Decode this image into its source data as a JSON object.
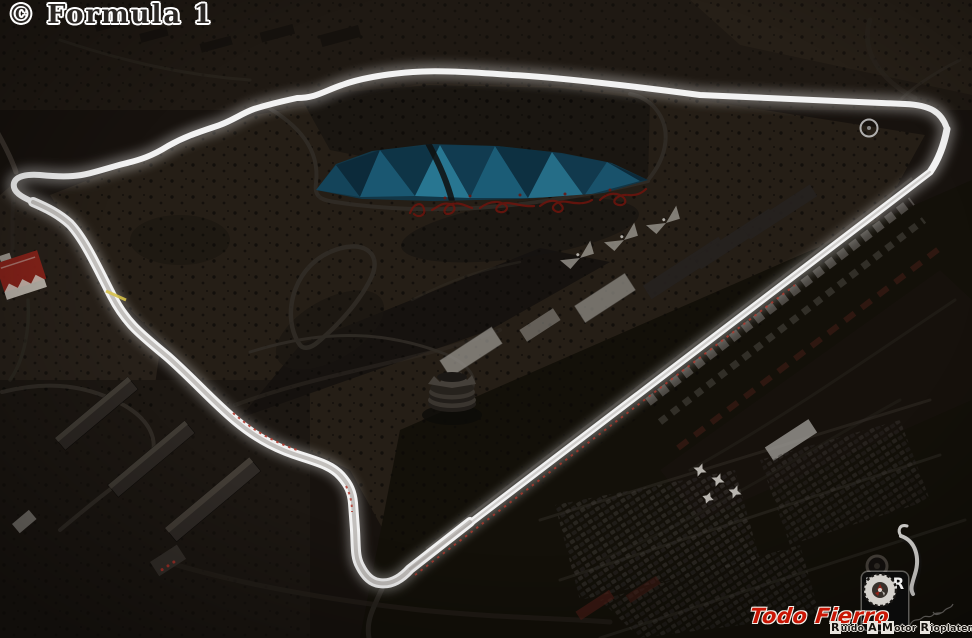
{
  "watermarks": {
    "formula1": "© Formula 1",
    "todo_fierro": "Todo Fierro",
    "rmr": "RMR",
    "rmr_caption_words": [
      "Ruido",
      "A",
      "Motor",
      "Rioplatense"
    ]
  },
  "colors": {
    "background": "#17120e",
    "track_light": "#f2f2f2",
    "kerb_red": "#b23a2e",
    "lake_teal": "#1d5a74",
    "script_red": "#6e140d",
    "watermark_red": "#c91605",
    "desert_interior": "#251e16"
  }
}
